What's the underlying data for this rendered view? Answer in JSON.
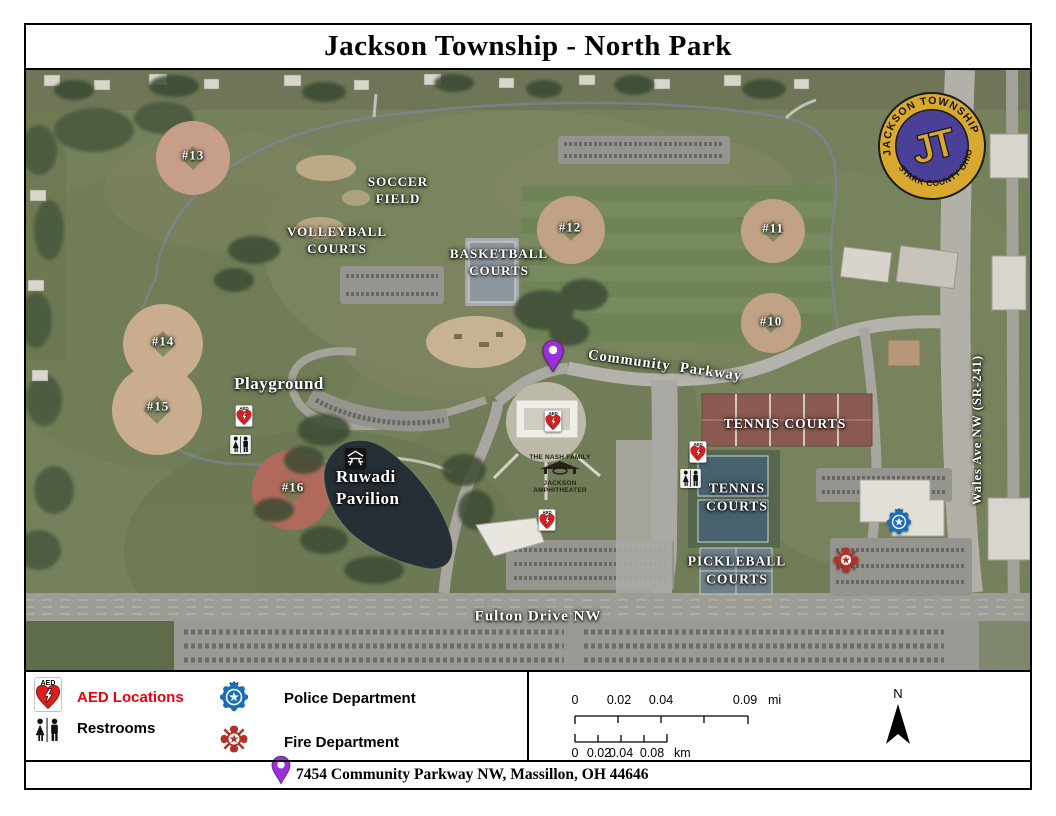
{
  "title": "Jackson Township - North Park",
  "logo": {
    "top_text": "JACKSON TOWNSHIP",
    "bottom_text": "STARK COUNTY OHIO",
    "monogram": "JT"
  },
  "map": {
    "ballfields": {
      "f10": "#10",
      "f11": "#11",
      "f12": "#12",
      "f13": "#13",
      "f14": "#14",
      "f15": "#15",
      "f16": "#16"
    },
    "areas": {
      "soccer": "SOCCER\nFIELD",
      "volleyball": "VOLLEYBALL\nCOURTS",
      "basketball": "BASKETBALL\nCOURTS",
      "playground": "Playground",
      "ruwadi": "Ruwadi\nPavilion",
      "tennis_upper": "TENNIS COURTS",
      "tennis_lower": "TENNIS\nCOURTS",
      "pickleball": "PICKLEBALL\nCOURTS"
    },
    "roads": {
      "community_parkway": "Community Parkway",
      "fulton": "Fulton Drive NW",
      "wales": "Wales Ave NW (SR-241)"
    },
    "amphitheater_sign": {
      "line1": "THE NASH FAMILY",
      "line2": "JACKSON",
      "line3": "AMPHITHEATER"
    }
  },
  "legend": {
    "aed_label": "AED Locations",
    "restrooms_label": "Restrooms",
    "police_label": "Police Department",
    "fire_label": "Fire Department",
    "aed_icon_label": "AED",
    "aed_text_color": "#e8000d"
  },
  "scale": {
    "mi": {
      "t0": "0",
      "t1": "0.02",
      "t2": "0.04",
      "t3": "0.09",
      "unit": "mi"
    },
    "km": {
      "t0": "0",
      "t1": "0.02",
      "t2": "0.04",
      "t3": "0.08",
      "unit": "km"
    }
  },
  "north_label": "N",
  "address": "7454 Community Parkway NW, Massillon, OH 44646",
  "colors": {
    "pin": "#9b30d9",
    "police_badge": "#1a6db8",
    "fire_badge": "#b33129",
    "aed_heart": "#e01d1d",
    "logo_gold": "#d9a92f",
    "logo_purple": "#4a4097"
  }
}
